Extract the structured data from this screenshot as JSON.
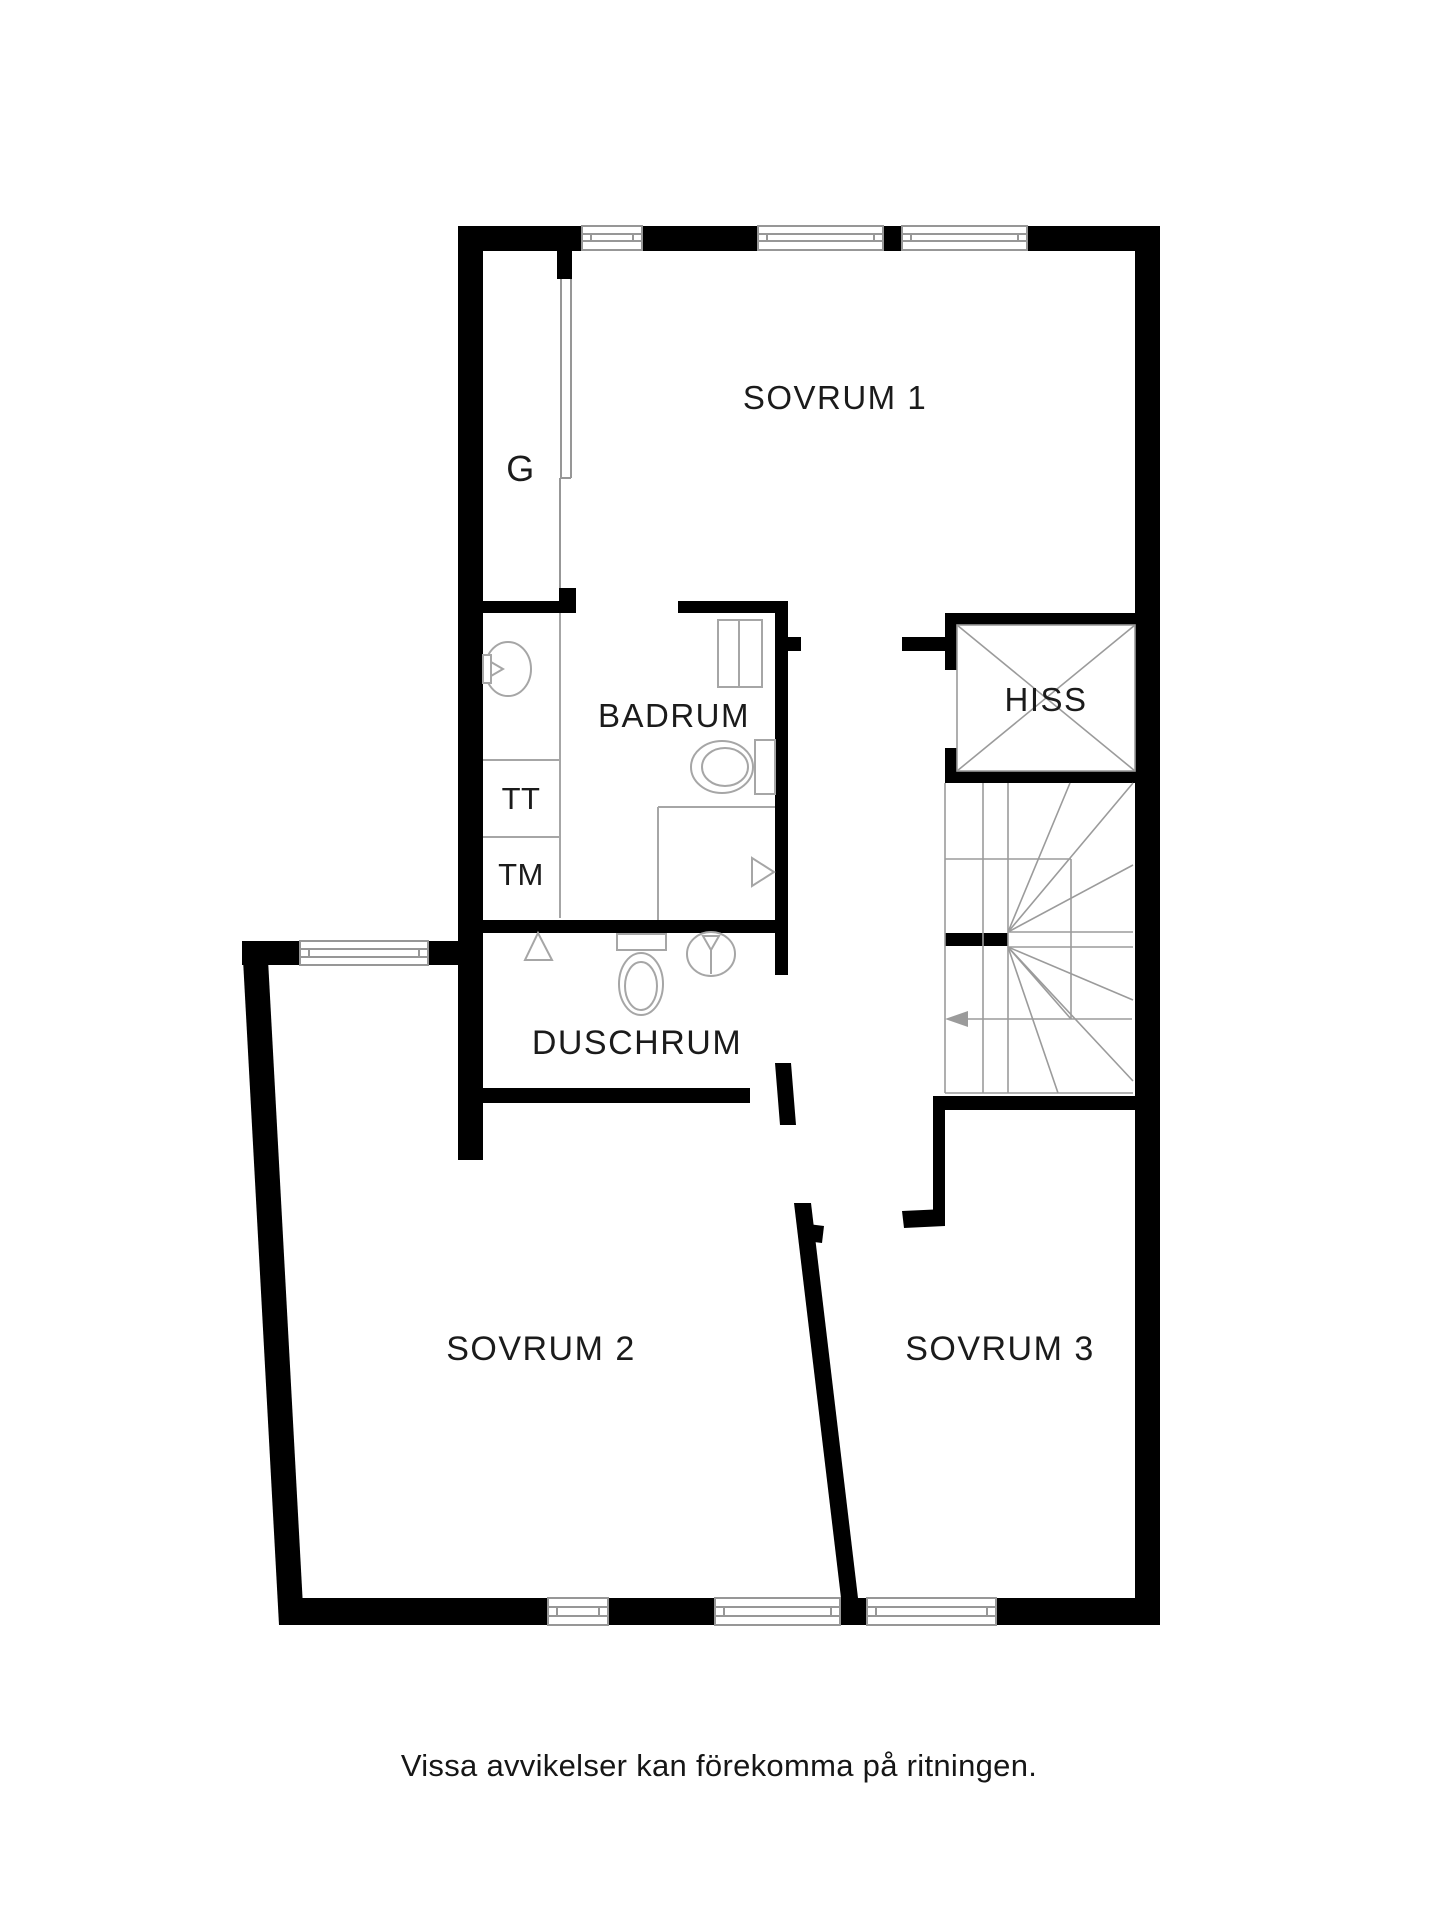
{
  "plan": {
    "rooms": {
      "sovrum1": {
        "label": "SOVRUM 1"
      },
      "sovrum2": {
        "label": "SOVRUM 2"
      },
      "sovrum3": {
        "label": "SOVRUM 3"
      },
      "badrum": {
        "label": "BADRUM"
      },
      "duschrum": {
        "label": "DUSCHRUM"
      },
      "hiss": {
        "label": "HISS"
      },
      "closet": {
        "label": "G"
      },
      "towel_dryer": {
        "label": "TT"
      },
      "washing_machine": {
        "label": "TM"
      }
    },
    "caption": "Vissa avvikelser kan förekomma på ritningen.",
    "symbols": {
      "stair_direction_arrow": "left-arrow",
      "elevator_shaft": "x-cross",
      "floor_drain": "triangle",
      "fixtures": [
        "sink",
        "toilet",
        "shower",
        "cabinet"
      ]
    },
    "colors": {
      "wall": "#000000",
      "thin_line": "#979797",
      "fixture_line": "#a6a6a6",
      "text": "#1b1b1b",
      "background": "#ffffff"
    }
  }
}
